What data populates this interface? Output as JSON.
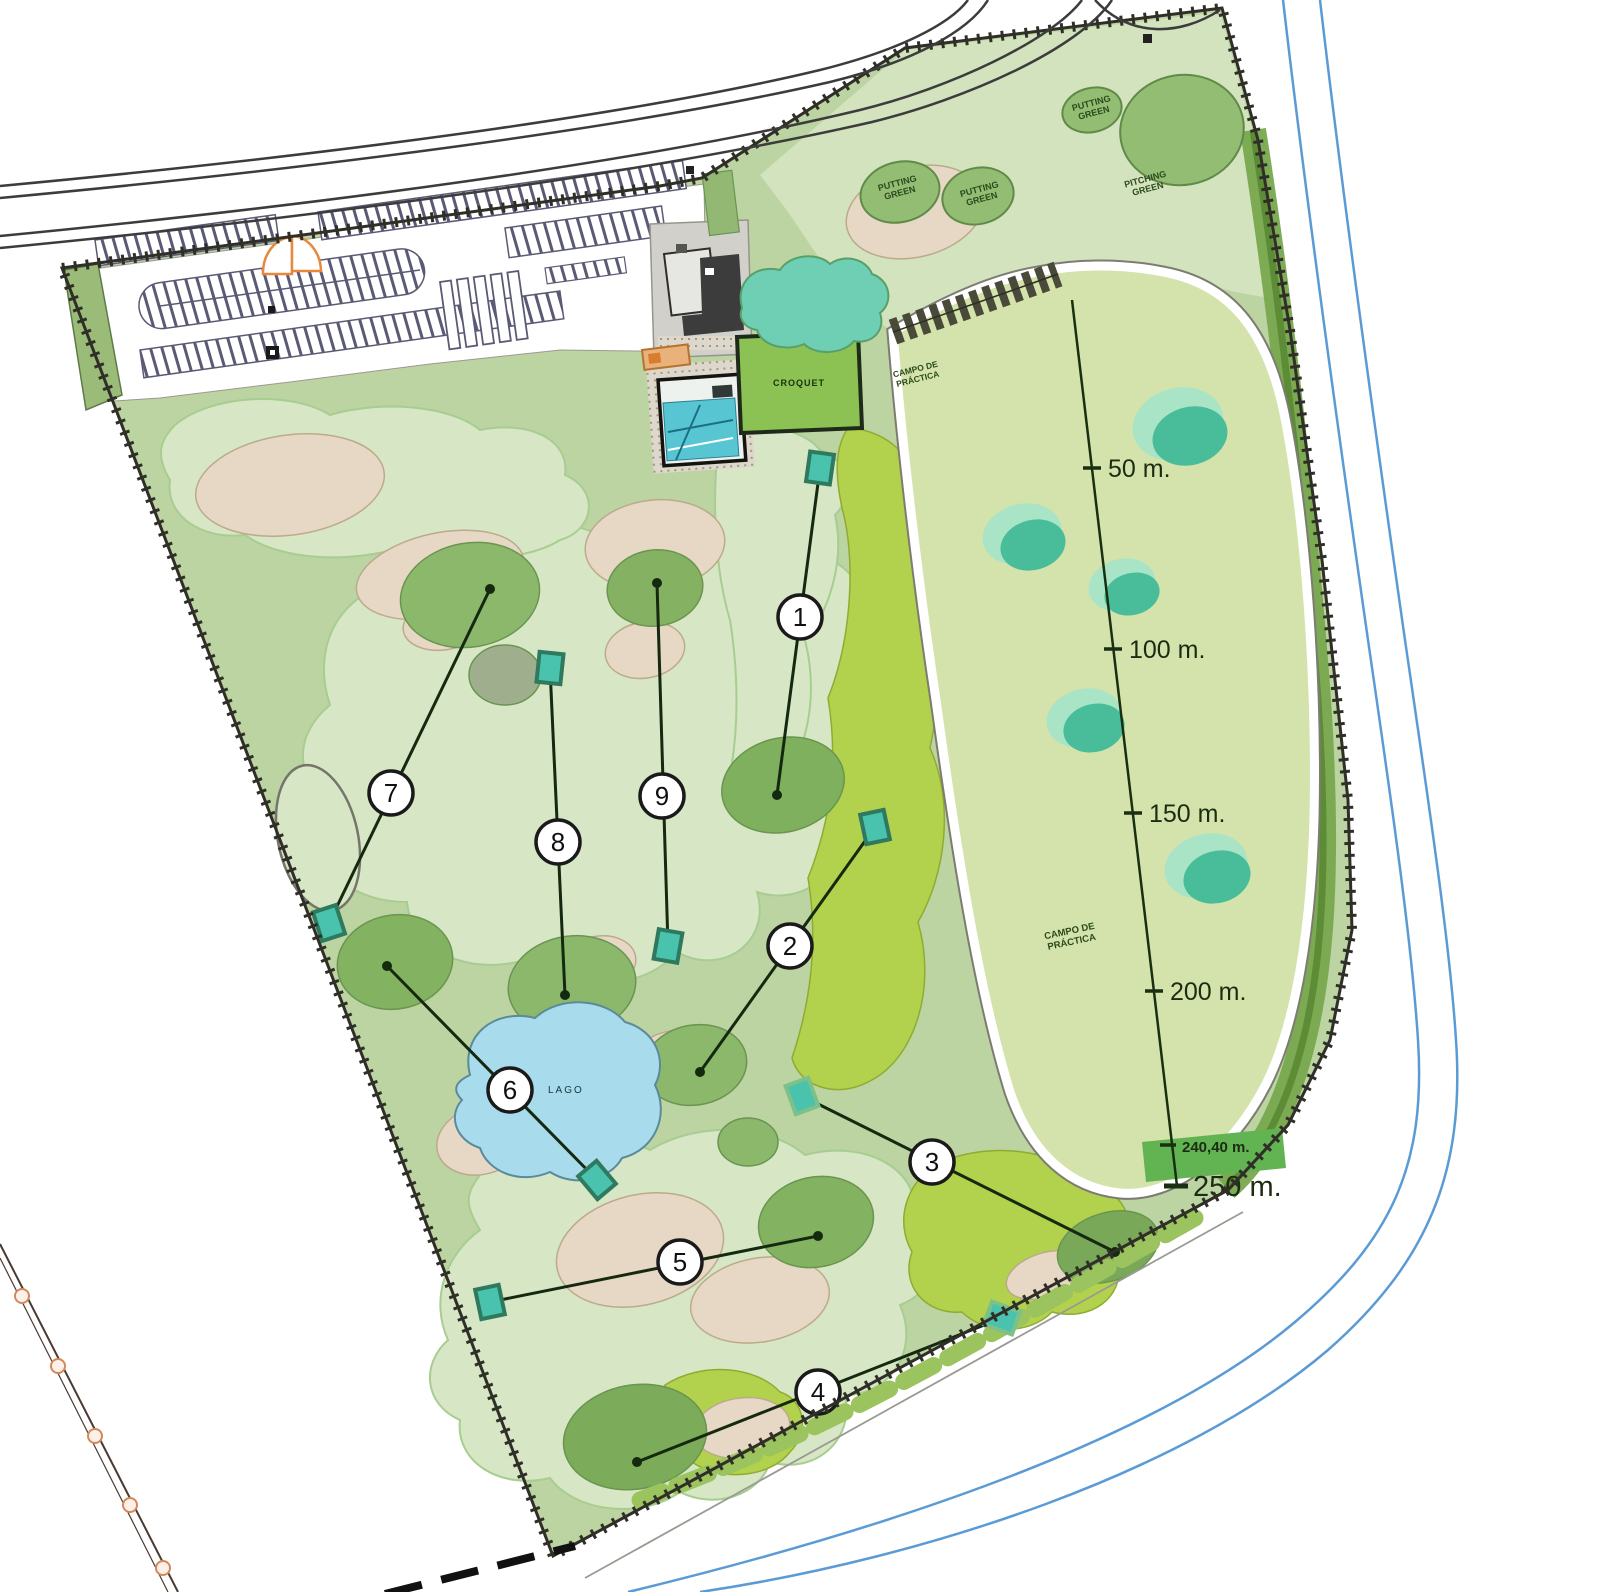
{
  "title": "Pitch & putt / golf practice facility site plan",
  "labels": {
    "putting_green": {
      "line1": "PUTTING",
      "line2": "GREEN"
    },
    "pitching_green": {
      "line1": "PITCHING",
      "line2": "GREEN"
    },
    "campo_practica": {
      "line1": "CAMPO DE",
      "line2": "PRÁCTICA"
    },
    "lago": "LAGO",
    "croquet": "CROQUET"
  },
  "holes": [
    {
      "number": "1"
    },
    {
      "number": "2"
    },
    {
      "number": "3"
    },
    {
      "number": "4"
    },
    {
      "number": "5"
    },
    {
      "number": "6"
    },
    {
      "number": "7"
    },
    {
      "number": "8"
    },
    {
      "number": "9"
    }
  ],
  "range_markers": [
    {
      "label": "50 m."
    },
    {
      "label": "100 m."
    },
    {
      "label": "150 m."
    },
    {
      "label": "200 m."
    },
    {
      "label": "240,40 m."
    },
    {
      "label": "250 m."
    }
  ],
  "colors": {
    "site_base_green": "#bcd3a2",
    "fairway_light_green": "#d7e7c5",
    "range_field_green": "#d3e3ab",
    "bright_green": "#b2d14c",
    "tree_green": "#8cb86c",
    "putting_green_fill": "#94bd74",
    "sand_tan": "#e6d8c4",
    "teal_target": "#49bd9a",
    "teal_halo": "#a9e4c6",
    "lake_blue": "#a8dcec",
    "pool_water": "#58c6d2",
    "road_line": "#3c3c3c",
    "blue_road": "#5b9bd5",
    "orange_accent": "#e8883c",
    "boundary_dark": "#2f2f28",
    "marker_text_green": "#1c2c12"
  }
}
